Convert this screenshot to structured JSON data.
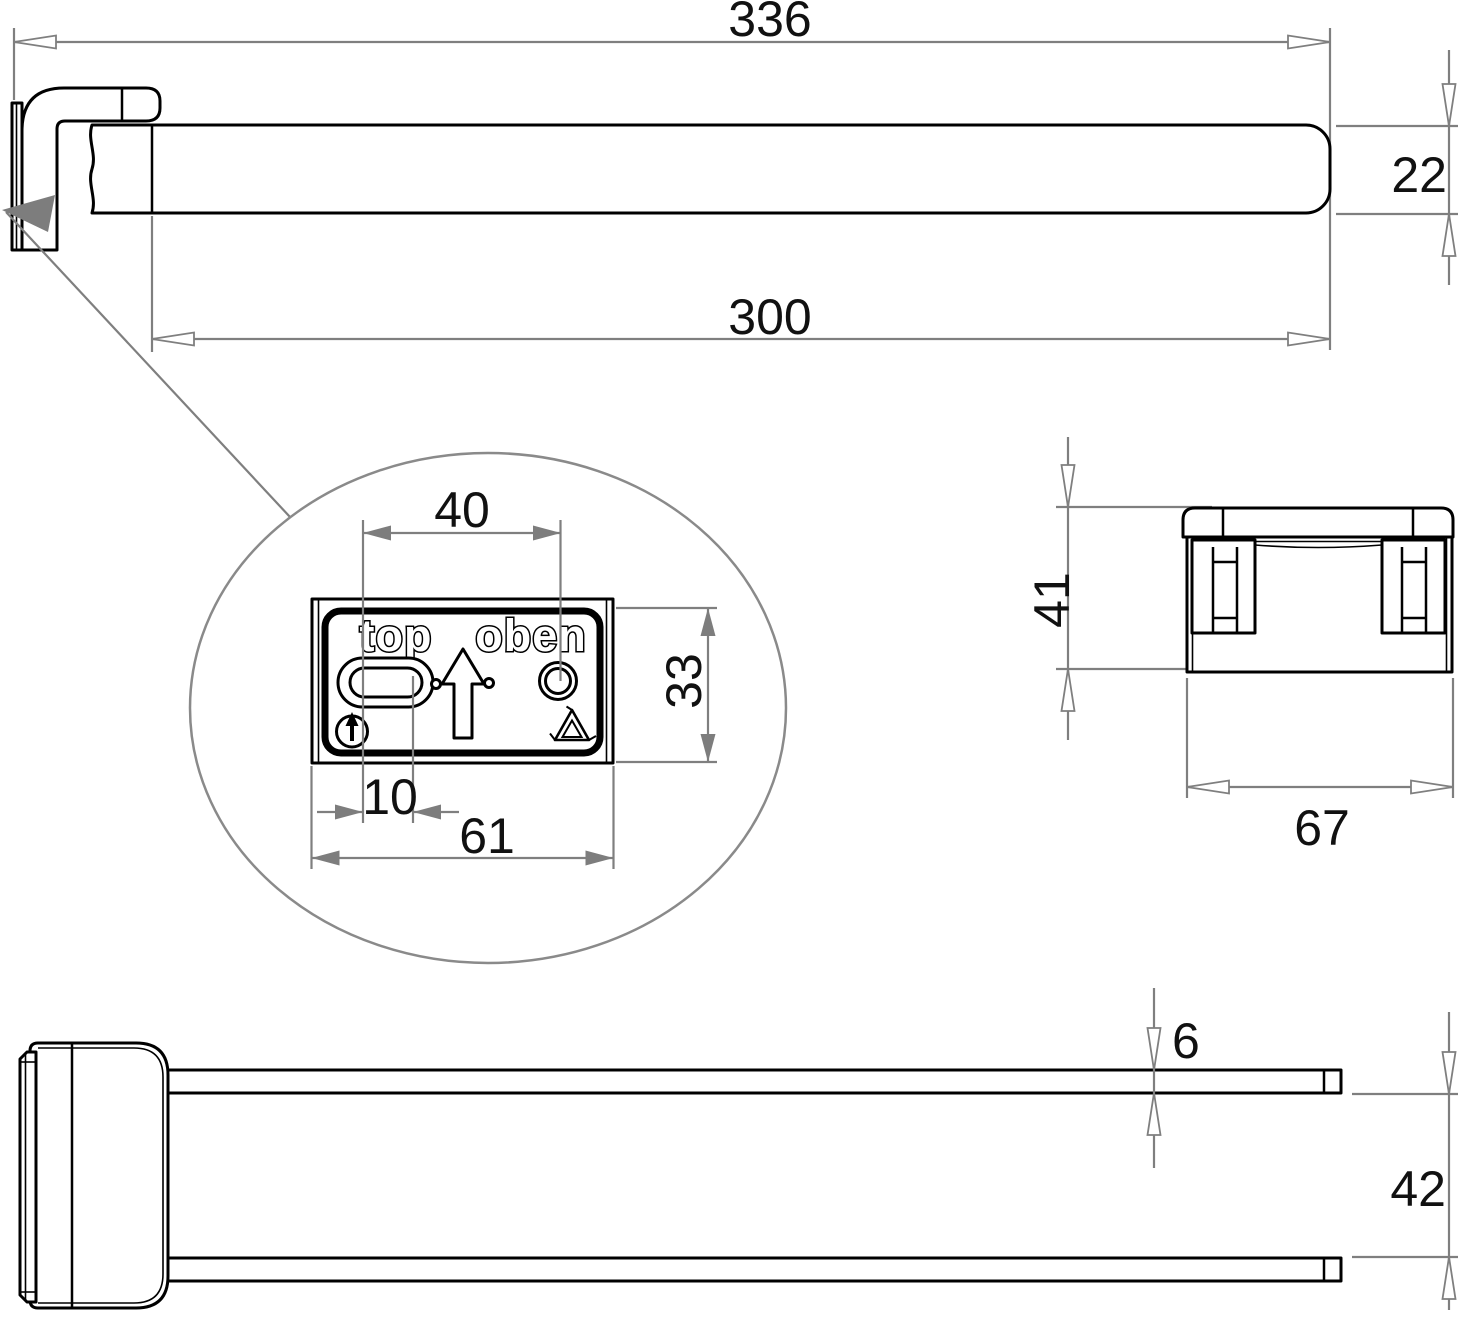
{
  "drawing": {
    "type": "technical-dimension-drawing",
    "subject": "double-arm towel bar with wall bracket",
    "labels": {
      "marking_top_en": "top",
      "marking_top_de": "oben"
    },
    "dimensions": {
      "front": {
        "overall_length": "336",
        "bar_length": "300",
        "bar_height": "22"
      },
      "detail": {
        "slot_to_hole_spacing": "40",
        "plate_height": "33",
        "slot_offset": "10",
        "plate_width": "61"
      },
      "side": {
        "bracket_height": "41",
        "bracket_width": "67"
      },
      "bottom": {
        "arm_thickness": "6",
        "arm_clearance": "42"
      }
    },
    "colors": {
      "geometry": "#000000",
      "dimension_lines": "#7f7f7f",
      "background": "#ffffff"
    }
  }
}
